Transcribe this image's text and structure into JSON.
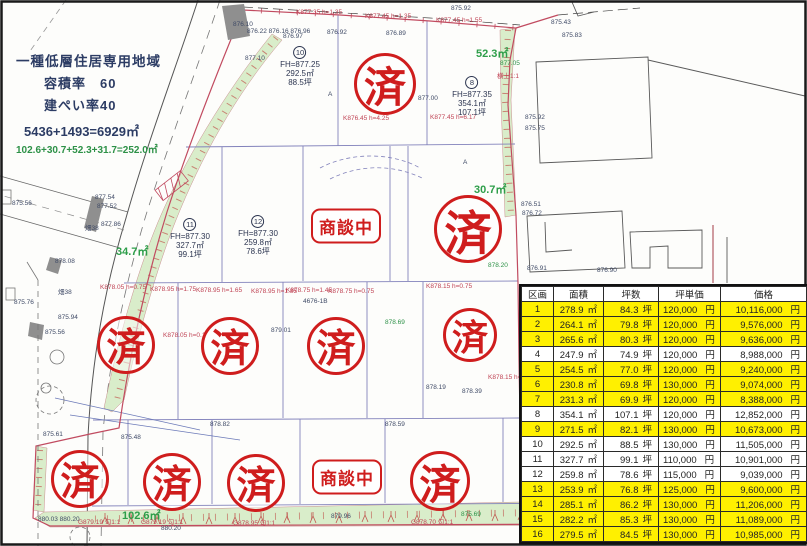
{
  "map": {
    "info_block": {
      "zoning": "一種低層住居専用地域",
      "volume_ratio": "容積率　60",
      "coverage_ratio": "建ぺい率40",
      "site_calc": "5436+1493=6929㎡",
      "green_calc": "102.6+30.7+52.3+31.7=252.0㎡"
    },
    "green_areas": [
      {
        "label": "52.3㎡",
        "x": 476,
        "y": 45
      },
      {
        "label": "30.7㎡",
        "x": 474,
        "y": 181
      },
      {
        "label": "34.7㎡",
        "x": 116,
        "y": 243
      },
      {
        "label": "102.6㎡",
        "x": 122,
        "y": 507
      }
    ],
    "plot_labels": [
      {
        "number": "10",
        "fh": "FH=877.25",
        "area": "292.5㎡",
        "tsubo": "88.5坪",
        "x": 300,
        "y": 46
      },
      {
        "number": "8",
        "fh": "FH=877.35",
        "area": "354.1㎡",
        "tsubo": "107.1坪",
        "x": 472,
        "y": 76
      },
      {
        "number": "11",
        "fh": "FH=877.30",
        "area": "327.7㎡",
        "tsubo": "99.1坪",
        "x": 190,
        "y": 218
      },
      {
        "number": "12",
        "fh": "FH=877.30",
        "area": "259.8㎡",
        "tsubo": "78.6坪",
        "x": 258,
        "y": 215
      }
    ],
    "stamps": [
      {
        "type": "sold",
        "label": "済",
        "x": 382,
        "y": 81,
        "r": 28
      },
      {
        "type": "sold",
        "label": "済",
        "x": 465,
        "y": 226,
        "r": 31
      },
      {
        "type": "sold",
        "label": "済",
        "x": 123,
        "y": 342,
        "r": 26
      },
      {
        "type": "sold",
        "label": "済",
        "x": 227,
        "y": 343,
        "r": 26
      },
      {
        "type": "sold",
        "label": "済",
        "x": 333,
        "y": 343,
        "r": 26
      },
      {
        "type": "sold",
        "label": "済",
        "x": 467,
        "y": 332,
        "r": 24
      },
      {
        "type": "sold",
        "label": "済",
        "x": 77,
        "y": 476,
        "r": 26
      },
      {
        "type": "sold",
        "label": "済",
        "x": 169,
        "y": 479,
        "r": 26
      },
      {
        "type": "sold",
        "label": "済",
        "x": 253,
        "y": 480,
        "r": 26
      },
      {
        "type": "sold",
        "label": "済",
        "x": 437,
        "y": 478,
        "r": 27
      },
      {
        "type": "negotiating",
        "label": "商談中",
        "x": 346,
        "y": 226
      },
      {
        "type": "negotiating",
        "label": "商談中",
        "x": 347,
        "y": 477
      }
    ],
    "annotations": [
      {
        "t": "K877.35 h=1.35",
        "x": 296,
        "y": 10,
        "c": "r"
      },
      {
        "t": "K877.45 h=1.35",
        "x": 365,
        "y": 14,
        "c": "r"
      },
      {
        "t": "K877.45 h=1.55",
        "x": 436,
        "y": 18,
        "c": "r"
      },
      {
        "t": "横土1:1",
        "x": 497,
        "y": 74,
        "c": "r"
      },
      {
        "t": "K877.45 h=6.17",
        "x": 430,
        "y": 115,
        "c": "r"
      },
      {
        "t": "K876.45 h=4.25",
        "x": 343,
        "y": 116,
        "c": "r"
      },
      {
        "t": "K878.05 h=0.75",
        "x": 100,
        "y": 285,
        "c": "r"
      },
      {
        "t": "K878.95 h=1.75",
        "x": 150,
        "y": 287,
        "c": "r"
      },
      {
        "t": "K878.95 h=1.65",
        "x": 196,
        "y": 288,
        "c": "r"
      },
      {
        "t": "K878.95 h=1.85",
        "x": 251,
        "y": 289,
        "c": "r"
      },
      {
        "t": "K878.75 h=1.45",
        "x": 286,
        "y": 288,
        "c": "r"
      },
      {
        "t": "K878.75 h=0.75",
        "x": 328,
        "y": 289,
        "c": "r"
      },
      {
        "t": "K878.15 h=0.75",
        "x": 426,
        "y": 284,
        "c": "r"
      },
      {
        "t": "K878.05 h=0.1",
        "x": 163,
        "y": 333,
        "c": "r"
      },
      {
        "t": "K878.15 h=0.15",
        "x": 488,
        "y": 375,
        "c": "r"
      },
      {
        "t": "G879.19 勾1:1",
        "x": 78,
        "y": 520,
        "c": "r"
      },
      {
        "t": "G879.19 勾1:1",
        "x": 141,
        "y": 520,
        "c": "r"
      },
      {
        "t": "G878.95 勾1:1",
        "x": 233,
        "y": 521,
        "c": "r"
      },
      {
        "t": "G878.70 勾1:1",
        "x": 411,
        "y": 520,
        "c": "r"
      },
      {
        "t": "876.10",
        "x": 233,
        "y": 22,
        "c": "b"
      },
      {
        "t": "876.22 876.16 876.96",
        "x": 247,
        "y": 29,
        "c": "b"
      },
      {
        "t": "876.97",
        "x": 283,
        "y": 34,
        "c": "b"
      },
      {
        "t": "876.92",
        "x": 327,
        "y": 30,
        "c": "b"
      },
      {
        "t": "876.89",
        "x": 386,
        "y": 31,
        "c": "b"
      },
      {
        "t": "875.92",
        "x": 451,
        "y": 6,
        "c": "b"
      },
      {
        "t": "877.10",
        "x": 245,
        "y": 56,
        "c": "b"
      },
      {
        "t": "877.00",
        "x": 418,
        "y": 96,
        "c": "b"
      },
      {
        "t": "877.54",
        "x": 95,
        "y": 195,
        "c": "b"
      },
      {
        "t": "877.52",
        "x": 97,
        "y": 204,
        "c": "b"
      },
      {
        "t": "877.86",
        "x": 101,
        "y": 222,
        "c": "b"
      },
      {
        "t": "878.08",
        "x": 55,
        "y": 259,
        "c": "b"
      },
      {
        "t": "875.56",
        "x": 12,
        "y": 201,
        "c": "b"
      },
      {
        "t": "畑38",
        "x": 85,
        "y": 226,
        "c": "b"
      },
      {
        "t": "畑38",
        "x": 58,
        "y": 290,
        "c": "b"
      },
      {
        "t": "875.76",
        "x": 14,
        "y": 300,
        "c": "b"
      },
      {
        "t": "875.94",
        "x": 58,
        "y": 315,
        "c": "b"
      },
      {
        "t": "875.56",
        "x": 45,
        "y": 330,
        "c": "b"
      },
      {
        "t": "876.51",
        "x": 521,
        "y": 202,
        "c": "b"
      },
      {
        "t": "876.72",
        "x": 522,
        "y": 211,
        "c": "b"
      },
      {
        "t": "875.43",
        "x": 551,
        "y": 20,
        "c": "b"
      },
      {
        "t": "875.83",
        "x": 562,
        "y": 33,
        "c": "b"
      },
      {
        "t": "875.92",
        "x": 525,
        "y": 115,
        "c": "b"
      },
      {
        "t": "875.75",
        "x": 525,
        "y": 126,
        "c": "b"
      },
      {
        "t": "876.91",
        "x": 527,
        "y": 266,
        "c": "b"
      },
      {
        "t": "876.90",
        "x": 597,
        "y": 268,
        "c": "b"
      },
      {
        "t": "4676-1B",
        "x": 303,
        "y": 299,
        "c": "b"
      },
      {
        "t": "879.01",
        "x": 271,
        "y": 328,
        "c": "b"
      },
      {
        "t": "878.19",
        "x": 426,
        "y": 385,
        "c": "b"
      },
      {
        "t": "878.39",
        "x": 462,
        "y": 389,
        "c": "b"
      },
      {
        "t": "878.82",
        "x": 210,
        "y": 422,
        "c": "b"
      },
      {
        "t": "878.59",
        "x": 385,
        "y": 422,
        "c": "b"
      },
      {
        "t": "875.61",
        "x": 43,
        "y": 432,
        "c": "b"
      },
      {
        "t": "875.48",
        "x": 121,
        "y": 435,
        "c": "b"
      },
      {
        "t": "880.03 880.20",
        "x": 38,
        "y": 517,
        "c": "b"
      },
      {
        "t": "880.20",
        "x": 161,
        "y": 526,
        "c": "b"
      },
      {
        "t": "879.96",
        "x": 331,
        "y": 514,
        "c": "b"
      },
      {
        "t": "A",
        "x": 328,
        "y": 92,
        "c": "b"
      },
      {
        "t": "A",
        "x": 463,
        "y": 160,
        "c": "b"
      },
      {
        "t": "877.05",
        "x": 500,
        "y": 61,
        "c": "g"
      },
      {
        "t": "878.20",
        "x": 488,
        "y": 263,
        "c": "g"
      },
      {
        "t": "878.69",
        "x": 385,
        "y": 320,
        "c": "g"
      },
      {
        "t": "875.69",
        "x": 461,
        "y": 512,
        "c": "g"
      }
    ]
  },
  "table": {
    "headers": [
      "区画",
      "面積",
      "坪数",
      "坪単価",
      "価格"
    ],
    "units": {
      "area": "㎡",
      "tsubo": "坪",
      "yen": "円"
    },
    "rows": [
      {
        "no": "1",
        "area": "278.9",
        "tsubo": "84.3",
        "unit_price": "120,000",
        "price": "10,116,000",
        "highlighted": true
      },
      {
        "no": "2",
        "area": "264.1",
        "tsubo": "79.8",
        "unit_price": "120,000",
        "price": "9,576,000",
        "highlighted": true
      },
      {
        "no": "3",
        "area": "265.6",
        "tsubo": "80.3",
        "unit_price": "120,000",
        "price": "9,636,000",
        "highlighted": true
      },
      {
        "no": "4",
        "area": "247.9",
        "tsubo": "74.9",
        "unit_price": "120,000",
        "price": "8,988,000",
        "highlighted": false
      },
      {
        "no": "5",
        "area": "254.5",
        "tsubo": "77.0",
        "unit_price": "120,000",
        "price": "9,240,000",
        "highlighted": true
      },
      {
        "no": "6",
        "area": "230.8",
        "tsubo": "69.8",
        "unit_price": "130,000",
        "price": "9,074,000",
        "highlighted": true
      },
      {
        "no": "7",
        "area": "231.3",
        "tsubo": "69.9",
        "unit_price": "120,000",
        "price": "8,388,000",
        "highlighted": true
      },
      {
        "no": "8",
        "area": "354.1",
        "tsubo": "107.1",
        "unit_price": "120,000",
        "price": "12,852,000",
        "highlighted": false
      },
      {
        "no": "9",
        "area": "271.5",
        "tsubo": "82.1",
        "unit_price": "130,000",
        "price": "10,673,000",
        "highlighted": true
      },
      {
        "no": "10",
        "area": "292.5",
        "tsubo": "88.5",
        "unit_price": "130,000",
        "price": "11,505,000",
        "highlighted": false
      },
      {
        "no": "11",
        "area": "327.7",
        "tsubo": "99.1",
        "unit_price": "110,000",
        "price": "10,901,000",
        "highlighted": false
      },
      {
        "no": "12",
        "area": "259.8",
        "tsubo": "78.6",
        "unit_price": "115,000",
        "price": "9,039,000",
        "highlighted": false
      },
      {
        "no": "13",
        "area": "253.9",
        "tsubo": "76.8",
        "unit_price": "125,000",
        "price": "9,600,000",
        "highlighted": true
      },
      {
        "no": "14",
        "area": "285.1",
        "tsubo": "86.2",
        "unit_price": "130,000",
        "price": "11,206,000",
        "highlighted": true
      },
      {
        "no": "15",
        "area": "282.2",
        "tsubo": "85.3",
        "unit_price": "130,000",
        "price": "11,089,000",
        "highlighted": true
      },
      {
        "no": "16",
        "area": "279.5",
        "tsubo": "84.5",
        "unit_price": "130,000",
        "price": "10,985,000",
        "highlighted": true
      }
    ]
  },
  "colors": {
    "stamp_red": "#cf1d1d",
    "highlight_yellow": "#fff000",
    "green_area": "#d9edca",
    "boundary_pink": "#c14b60",
    "plot_line": "#8282bb",
    "green_text": "#2d9e49",
    "info_text": "#2c3c64"
  }
}
